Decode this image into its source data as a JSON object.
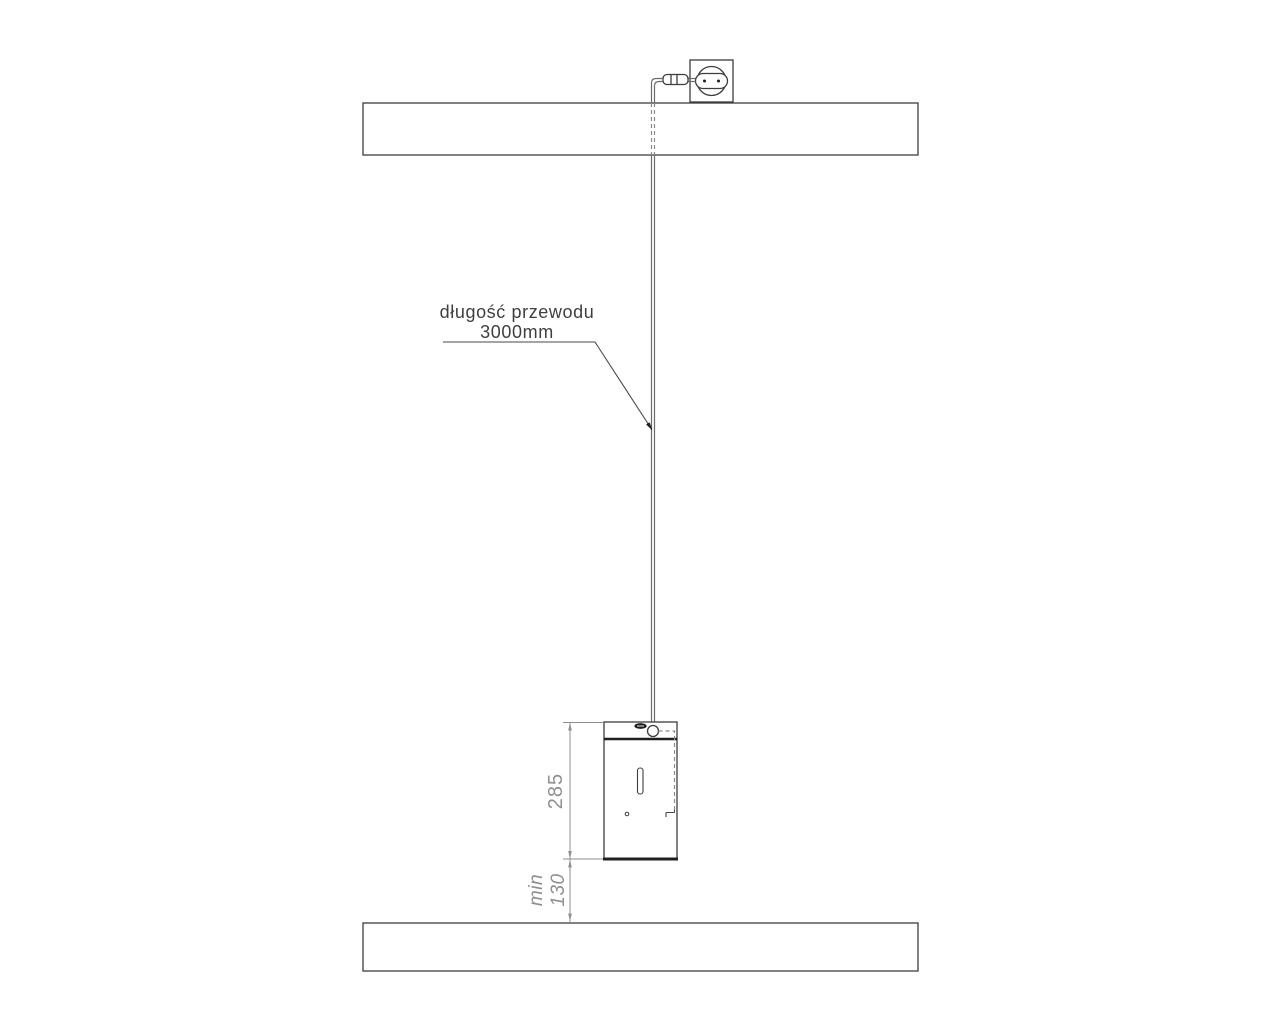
{
  "drawing": {
    "type": "installation-diagram",
    "callout": {
      "line1": "długość przewodu",
      "line2": "3000mm"
    },
    "dimensions": {
      "dispenser_height": "285",
      "min_label": "min",
      "min_clearance": "130"
    },
    "colors": {
      "outline_dark": "#3d3d3d",
      "outline_thick": "#1f1f1f",
      "cable_gray": "#6b6b6b",
      "dimension_gray": "#8f8f8f",
      "label_text": "#3f3f3f",
      "background": "#ffffff"
    }
  }
}
